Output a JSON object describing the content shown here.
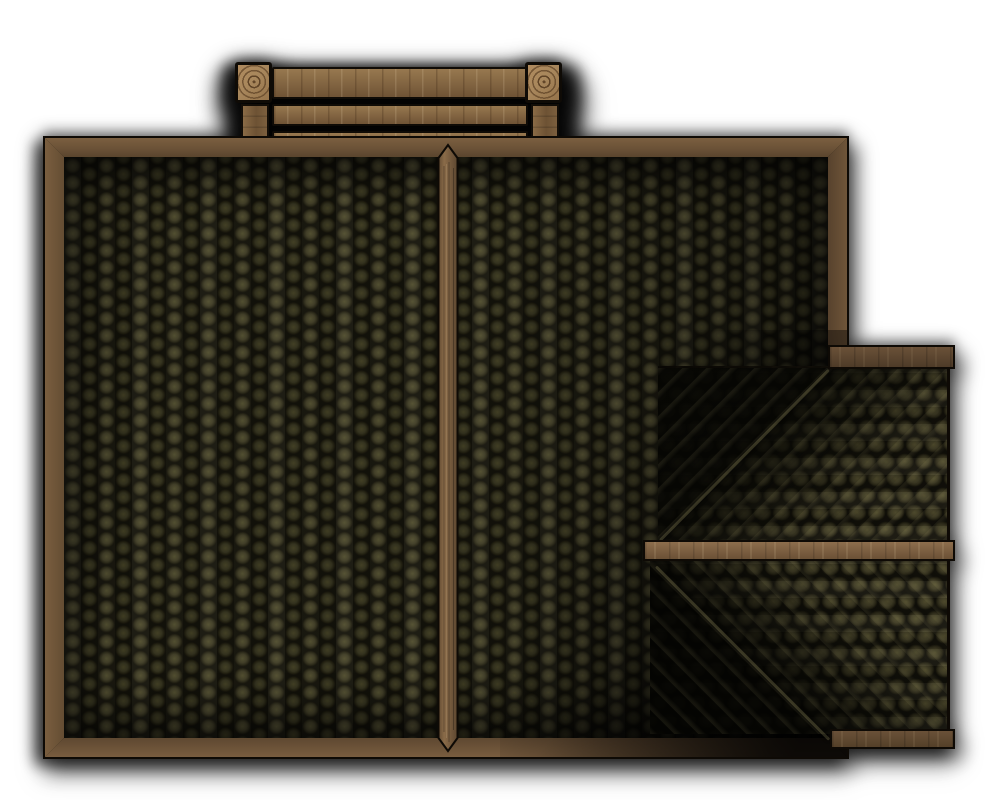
{
  "scene": {
    "description": "Top-down battlemap asset: wooden building roof with dark olive round shingles, framed by timber beams, a plank balcony at the top edge and a stepped lower extension roof on the right side",
    "view": "top-down",
    "background": "#ffffff"
  },
  "asset": {
    "type": "roof-tile",
    "parts": [
      "balcony",
      "main-roof",
      "ridge-beam",
      "extension-roof-upper",
      "extension-roof-lower",
      "extension-beam-top",
      "extension-beam-middle",
      "extension-beam-bottom"
    ],
    "balcony": {
      "plank_count": 3,
      "post_count": 2
    }
  },
  "colors": {
    "page_bg": "#ffffff",
    "outline": "#0e0a05",
    "shingle_hi": "#4f4c2e",
    "shingle_mid": "#3e3b25",
    "ext_shingle_hi": "#5a5533",
    "ext_shingle_mid": "#47432a",
    "frame_wood_light": "#7b5f40",
    "frame_wood_dark": "#5a452e",
    "ridge_beam_light": "#8a6b49",
    "ridge_beam_dark": "#634c33",
    "balcony_wood_light": "#97784f",
    "balcony_wood_dark": "#6f5335",
    "balcony_post_light": "#a8875c",
    "balcony_ring": "#5f4326",
    "mid_beam_light": "#8d6e4d",
    "mid_beam_dark": "#6b5136",
    "top_beam_light": "#6a5138",
    "top_beam_dark": "#4e3b28",
    "shadow": "#000000"
  }
}
